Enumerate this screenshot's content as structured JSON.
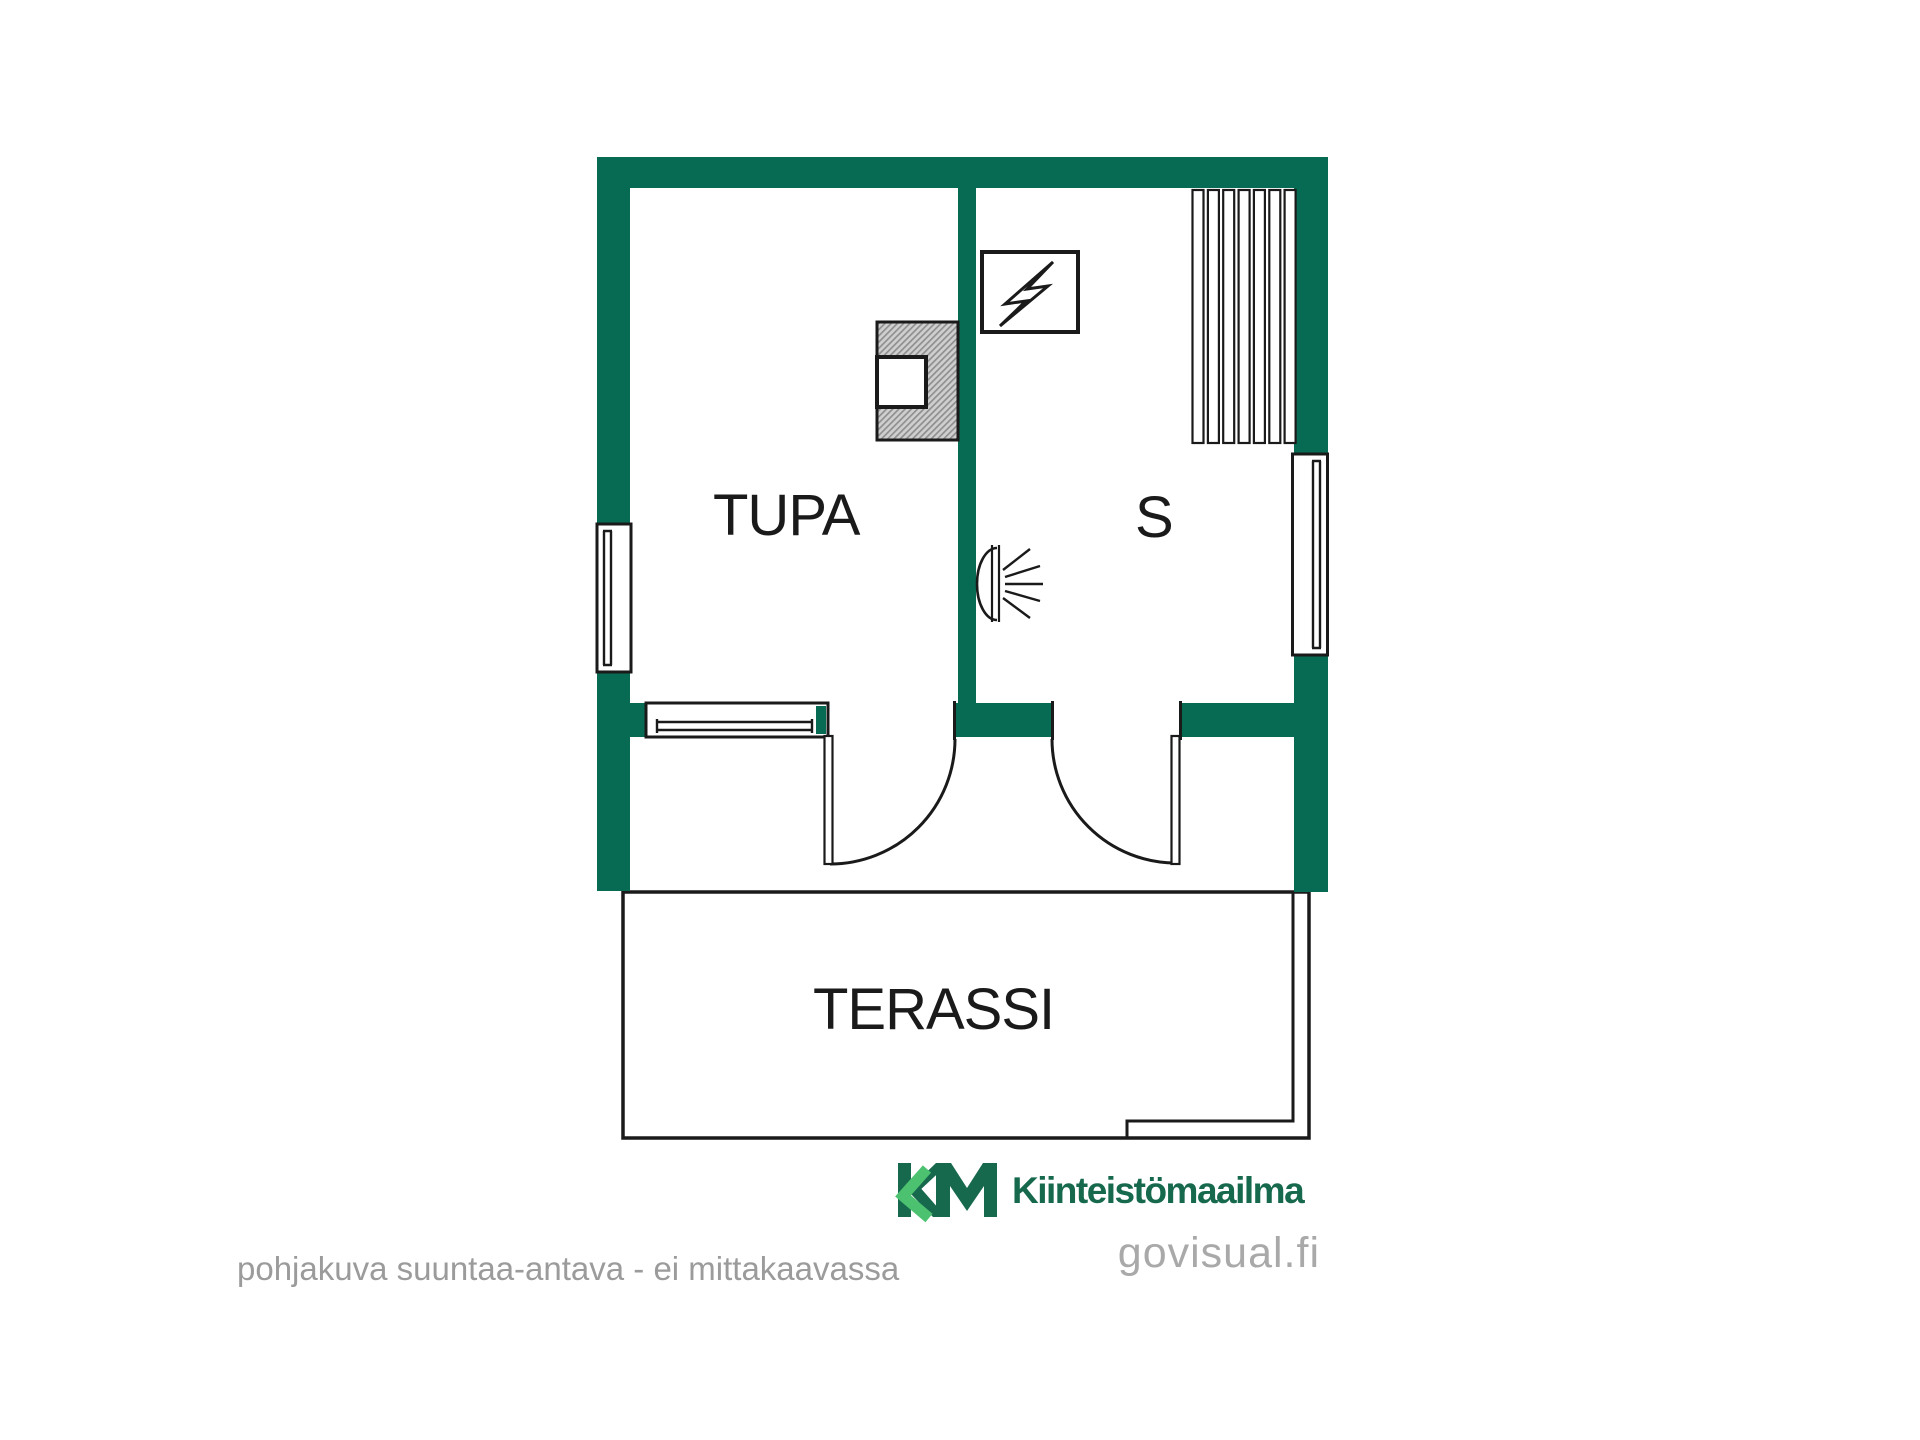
{
  "colors": {
    "wall_green": "#076a52",
    "line_black": "#1a1a1a",
    "logo_dark_green": "#17694e",
    "logo_light_green": "#4cc170",
    "footer_gray": "#9b9b9b",
    "website_gray": "#a9a9a9"
  },
  "rooms": {
    "tupa": {
      "label": "TUPA"
    },
    "sauna": {
      "label": "S"
    },
    "terrace": {
      "label": "TERASSI"
    }
  },
  "symbols": {
    "electric_panel": "electric-panel-icon",
    "sauna_light": "wall-light-icon",
    "stove": "sauna-stove",
    "bench": "sauna-bench",
    "window": "window",
    "door": "door-swing"
  },
  "branding": {
    "logo_mark": "KM",
    "company": "Kiinteistömaailma",
    "website": "govisual.fi"
  },
  "footer": {
    "disclaimer": "pohjakuva suuntaa-antava - ei mittakaavassa"
  }
}
